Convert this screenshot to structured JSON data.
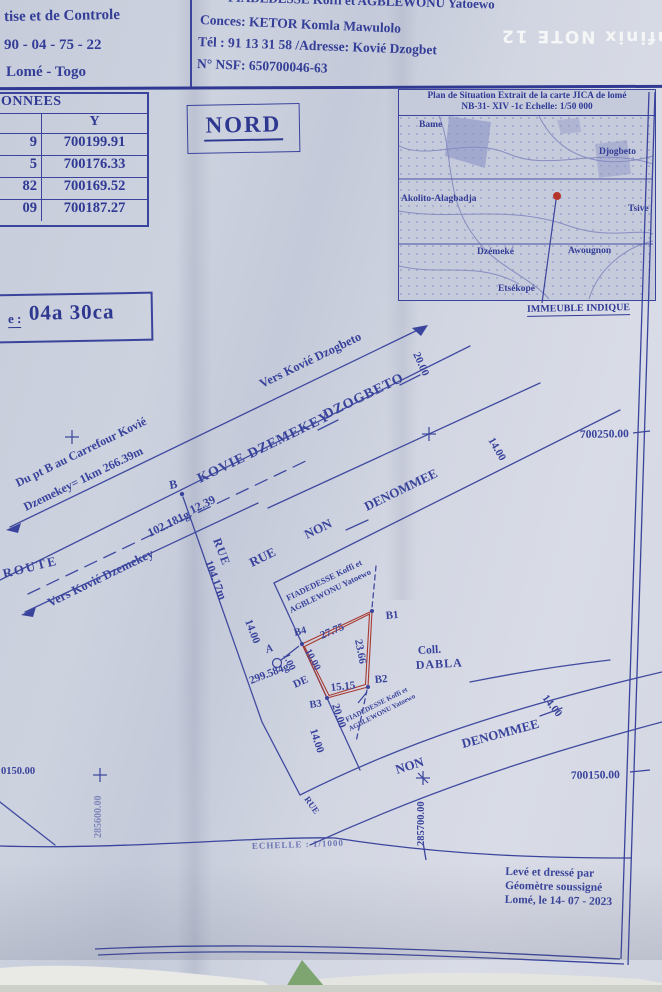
{
  "watermark": "Infinix NOTE 12",
  "header": {
    "firm_line1": "tise et de Controle",
    "firm_line2": "90 - 04 - 75 - 22",
    "firm_line3": "Lomé - Togo",
    "owner_line": "FIADEDESSE Koffi et AGBLEWONU Yatoewo",
    "concession": "Conces: KETOR Komla Mawulolo",
    "tel_address": "Tél : 91 13 31 58 /Adresse: Kovié Dzogbet",
    "nsf": "N° NSF:  650700046-63"
  },
  "coords_table": {
    "title": "ONNEES",
    "y_header": "Y",
    "rows": [
      {
        "x": "9",
        "y": "700199.91"
      },
      {
        "x": "5",
        "y": "700176.33"
      },
      {
        "x": "82",
        "y": "700169.52"
      },
      {
        "x": "09",
        "y": "700187.27"
      }
    ]
  },
  "north": "NORD",
  "area": {
    "label": "e :",
    "value": "04a 30ca"
  },
  "map": {
    "title1": "Plan de Situation Extrait de la carte JICA de lomé",
    "title2": "NB-31- XIV -1c Echelle: 1/50 000",
    "places": {
      "bame": "Bame",
      "djogbeto": "Djogbeto",
      "akolito": "Akolito-Alagbadja",
      "tsive": "Tsive",
      "dzemeke": "Dzémeké",
      "awougnon": "Awougnon",
      "etsekope": "Etsékopé"
    },
    "marker": "IMMEUBLE INDIQUE"
  },
  "plan": {
    "vers_dzogbeto": "Vers Kovié Dzogbeto",
    "road1a": "KOVIE DZEMEKEY",
    "road1b": "DZOGBETO",
    "note1": "Du pt B au Carrefour Kovié",
    "note2": "Dzemekey= 1km 266.39m",
    "route": "ROUTE",
    "angle_b": "102.181g",
    "pt_b": "B",
    "d_12_39": "12.39",
    "rue_a": "RUE",
    "rue_len": "104.17m",
    "vers_dzemekey": "Vers Kovié Dzemekey",
    "w14a": "14.00",
    "rue_b": "RUE",
    "non_a": "NON",
    "den_a": "DENOMMEE",
    "w20a": "20.00",
    "w14b": "14.00",
    "grid_n_top": "700250.00",
    "owner1a": "FIADEDESSE Koffi et",
    "owner1b": "AGBLEWONU Yatoewo",
    "b1": "B1",
    "b2": "B2",
    "b3": "B3",
    "b4": "B4",
    "s_27_75": "27.75",
    "s_23_66": "23.66",
    "s_15_15": "15.15",
    "s_10_00": "10.00",
    "pt_a": "A",
    "d_1_00": "1.00",
    "angle_a": "299.584g",
    "de": "DE",
    "coll_a": "Coll.",
    "coll_b": "DABLA",
    "owner2a": "FIADEDESSE Koffi et",
    "owner2b": "AGBLEWONU Yatoewo",
    "w20b": "20.00",
    "w14c": "14.00",
    "non_b": "NON",
    "den_b": "DENOMMEE",
    "w14d": "14.00",
    "grid_n_bot": "700150.00",
    "grid_e_right": "285700.00",
    "rue_c": "RUE",
    "grid_n_left": "0150.00",
    "grid_e_left": "285600.00",
    "scale": "ECHELLE : 1/1000"
  },
  "footer": {
    "l1": "Levé et dressé par",
    "l2": "Géomètre soussigné",
    "l3": "Lomé, le 14- 07 - 2023"
  },
  "colors": {
    "ink": "#39439b",
    "parcel_red": "#a8382f",
    "marker_red": "#b5342c"
  }
}
